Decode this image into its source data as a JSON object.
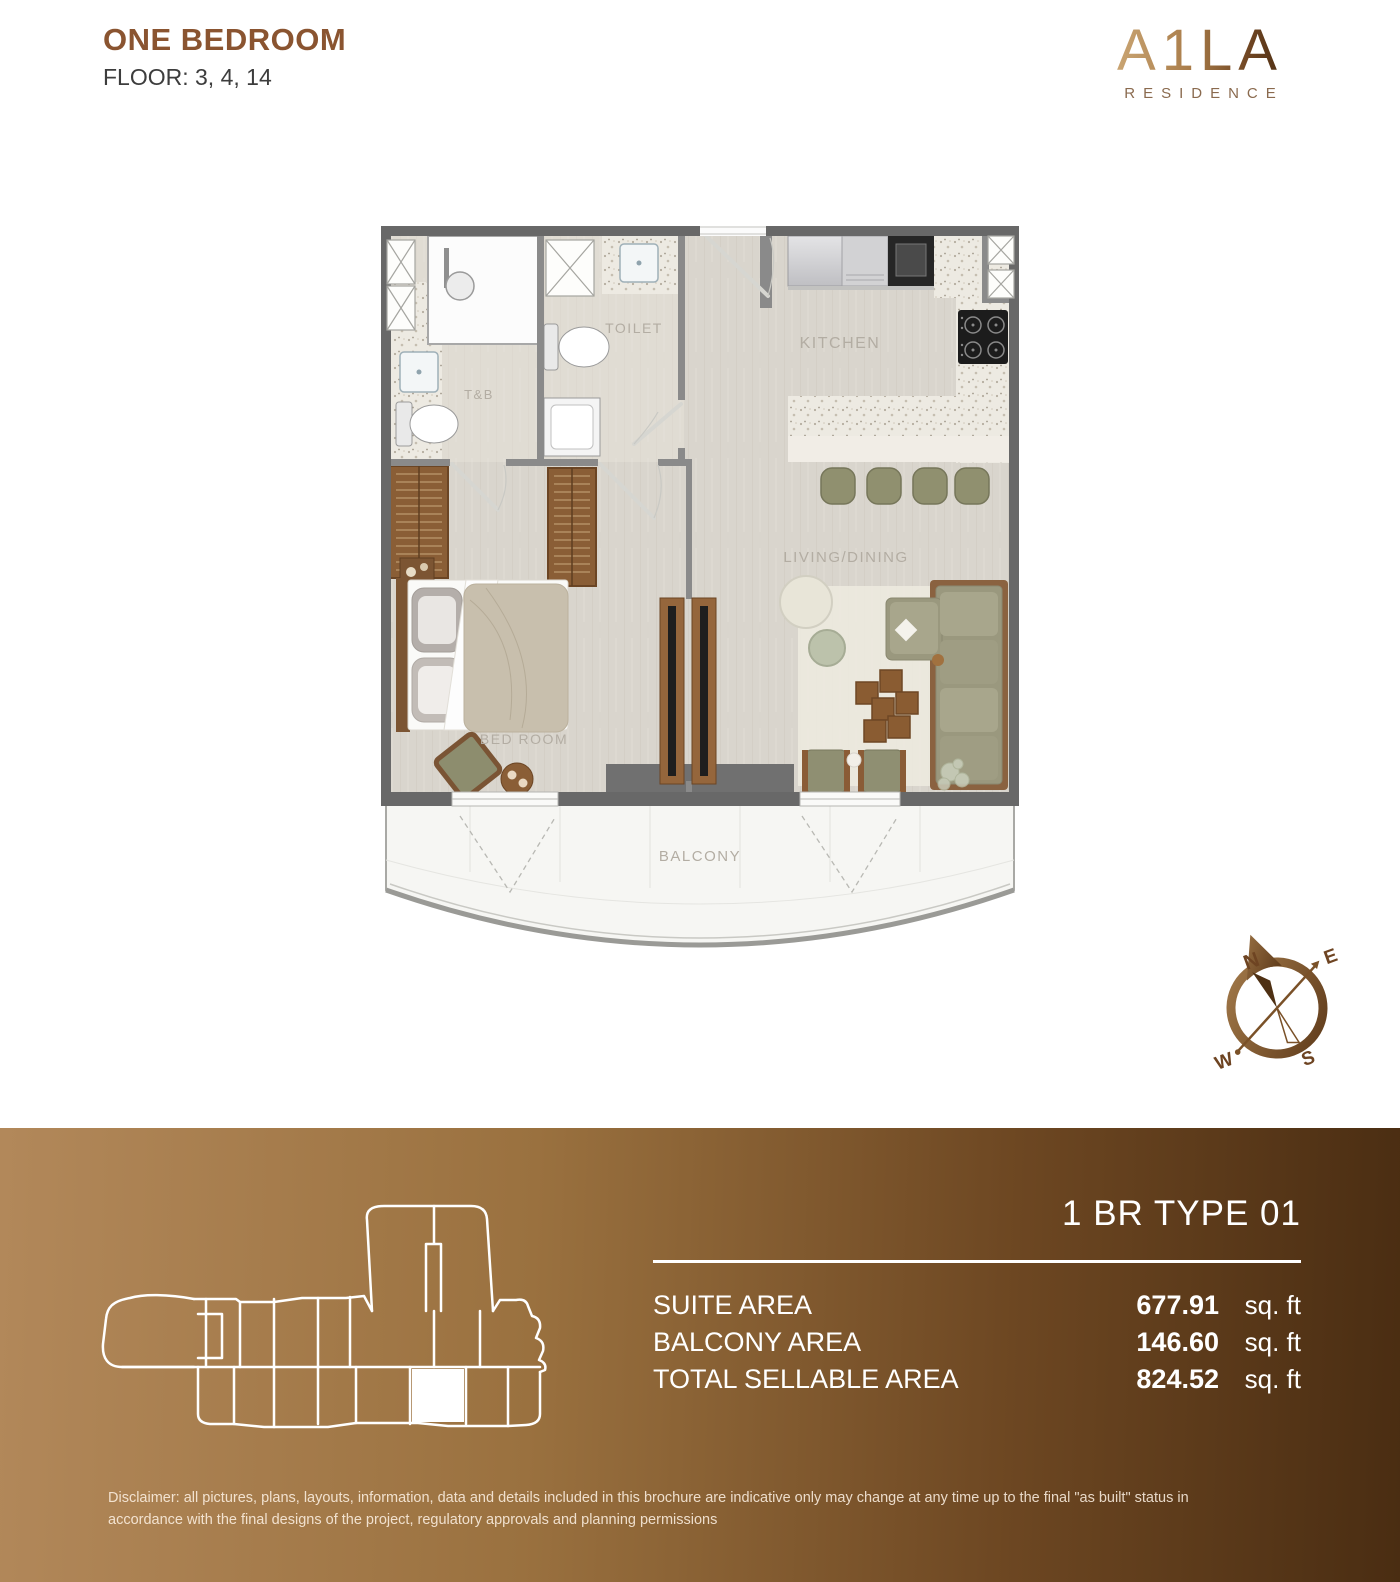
{
  "header": {
    "title": "ONE BEDROOM",
    "floors": "FLOOR: 3, 4, 14"
  },
  "brand": {
    "name": "A1LA",
    "tagline": "RESIDENCE",
    "accent_color": "#8a5430",
    "logo_gradient": [
      "#c9a472",
      "#4f3014"
    ]
  },
  "floor_plan": {
    "labels": {
      "tb": "T&B",
      "toilet": "TOILET",
      "kitchen": "KITCHEN",
      "living": "LIVING/DINING",
      "bedroom": "BED ROOM",
      "balcony": "BALCONY"
    }
  },
  "compass": {
    "n": "N",
    "e": "E",
    "s": "S",
    "w": "W"
  },
  "footer": {
    "unit_type": "1 BR TYPE 01",
    "rows": [
      {
        "label": "SUITE AREA",
        "value": "677.91",
        "unit": "sq. ft"
      },
      {
        "label": "BALCONY AREA",
        "value": "146.60",
        "unit": "sq. ft"
      },
      {
        "label": "TOTAL SELLABLE AREA",
        "value": "824.52",
        "unit": "sq. ft"
      }
    ],
    "gradient_start": "#b2885a",
    "gradient_end": "#4a2d12",
    "disclaimer": "Disclaimer: all pictures, plans, layouts, information, data and details included in this brochure are indicative only may change at any time up to the final \"as built\" status in accordance with the final designs of the project, regulatory approvals and planning permissions"
  }
}
